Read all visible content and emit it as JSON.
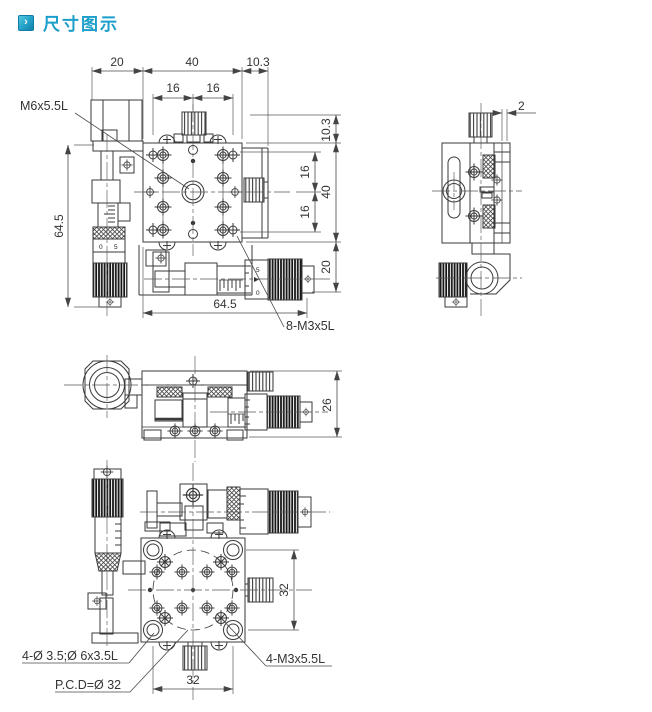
{
  "header": {
    "title": "尺寸图示"
  },
  "colors": {
    "title": "#1b9ec9",
    "line": "#3a3a3a",
    "icon_bg": "#29a7cc"
  },
  "drawing": {
    "top_view": {
      "dim_top_20": "20",
      "dim_top_40": "40",
      "dim_top_10_3": "10.3",
      "dim_top_16a": "16",
      "dim_top_16b": "16",
      "dim_left_64_5": "64.5",
      "dim_bottom_64_5": "64.5",
      "dim_right_10_3": "10.3",
      "dim_right_16a": "16",
      "dim_right_16b": "16",
      "dim_right_40": "40",
      "dim_right_20": "20",
      "label_center_hole": "M6x5.5L",
      "label_screw_holes": "8-M3x5L",
      "thimble_5": "5",
      "thimble_0": "0"
    },
    "side_view": {
      "dim_plate_2": "2"
    },
    "front_view": {
      "dim_height_26": "26"
    },
    "bottom_view": {
      "dim_right_32": "32",
      "dim_bottom_32": "32",
      "label_corner_holes": "4-Ø 3.5;Ø 6x3.5L",
      "label_pcd": "P.C.D=Ø 32",
      "label_m3_holes": "4-M3x5.5L"
    }
  }
}
